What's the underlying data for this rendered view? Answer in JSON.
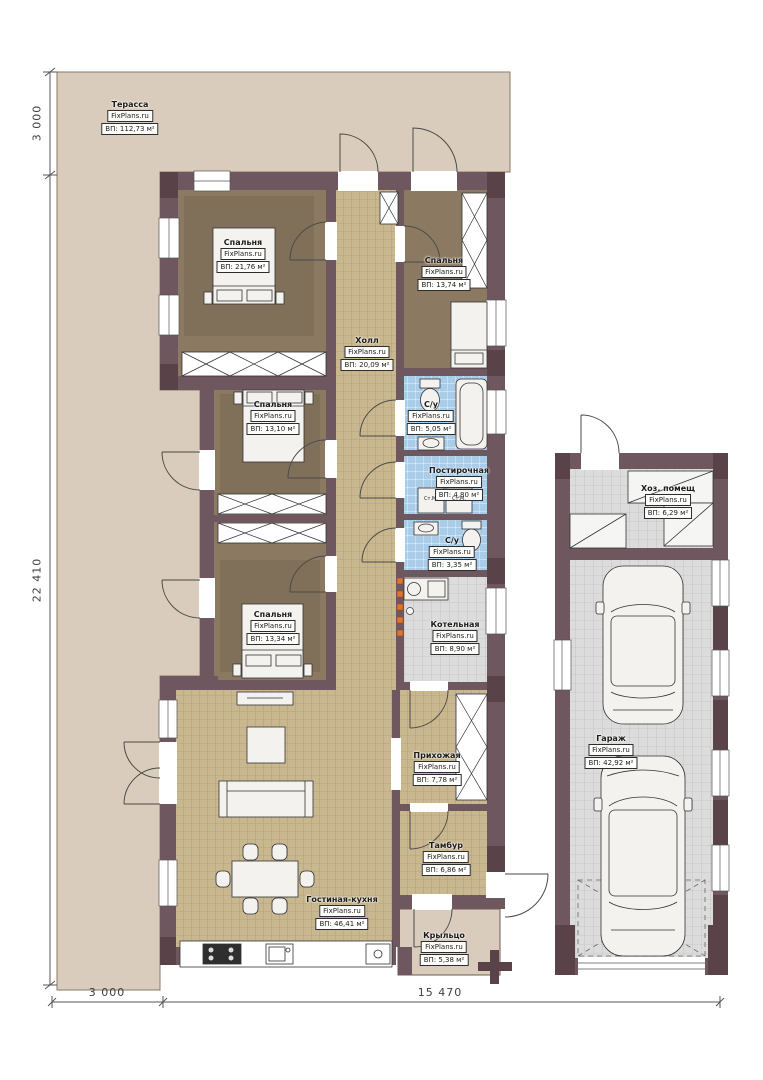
{
  "watermark": "FixPlans.ru",
  "rooms": [
    {
      "name": "Терасса",
      "area": "ВП: 112,73 м²"
    },
    {
      "name": "Спальня",
      "area": "ВП: 21,76 м²"
    },
    {
      "name": "Спальня",
      "area": "ВП: 13,74 м²"
    },
    {
      "name": "Холл",
      "area": "ВП: 20,09 м²"
    },
    {
      "name": "Спальня",
      "area": "ВП: 13,10 м²"
    },
    {
      "name": "С/у",
      "area": "ВП: 5,05 м²"
    },
    {
      "name": "Постирочная",
      "area": "ВП: 4,80 м²"
    },
    {
      "name": "С/у",
      "area": "ВП: 3,35 м²"
    },
    {
      "name": "Спальня",
      "area": "ВП: 13,34 м²"
    },
    {
      "name": "Котельная",
      "area": "ВП: 8,90 м²"
    },
    {
      "name": "Прихожая",
      "area": "ВП: 7,78 м²"
    },
    {
      "name": "Тамбур",
      "area": "ВП: 6,86 м²"
    },
    {
      "name": "Гостиная-кухня",
      "area": "ВП: 46,41 м²"
    },
    {
      "name": "Крыльцо",
      "area": "ВП: 5,38 м²"
    },
    {
      "name": "Хоз. помещ",
      "area": "ВП: 6,29 м²"
    },
    {
      "name": "Гараж",
      "area": "ВП: 42,92 м²"
    }
  ],
  "appliances": {
    "washing_machine": "Ст.М."
  },
  "dimensions": {
    "left_top": "3 000",
    "left_main": "22 410",
    "bottom_left": "3 000",
    "bottom_main": "15 470"
  },
  "colors": {
    "terrace": "#d9ccbc",
    "wall": "#6e575e",
    "wall_dark": "#594349",
    "bedroom_floor": "#8b7a61",
    "tile_tan": "#c9b78f",
    "tile_blue": "#a9cce9",
    "tile_gray": "#dcdcdc",
    "furniture": "#f3f2ef",
    "accent_orange": "#e2732d"
  }
}
